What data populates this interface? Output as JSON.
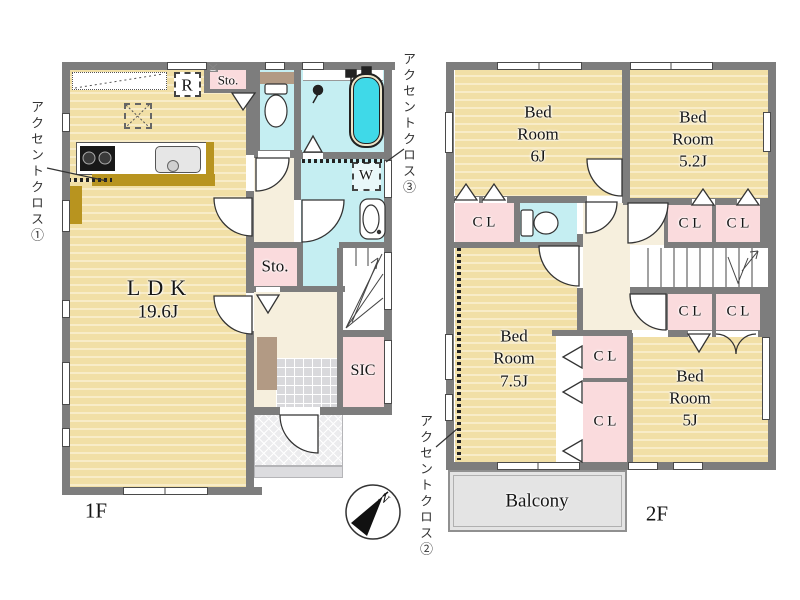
{
  "floor1": {
    "label": "1F",
    "ldk_name": "LDK",
    "ldk_size": "19.6J",
    "storage_top": "Sto.",
    "storage_mid": "Sto.",
    "sic": "SIC",
    "fridge": "R",
    "washer": "W"
  },
  "floor2": {
    "label": "2F",
    "balcony": "Balcony",
    "closet_label": "C L",
    "bedrooms": [
      {
        "line1": "Bed",
        "line2": "Room",
        "size": "6J"
      },
      {
        "line1": "Bed",
        "line2": "Room",
        "size": "5.2J"
      },
      {
        "line1": "Bed",
        "line2": "Room",
        "size": "7.5J"
      },
      {
        "line1": "Bed",
        "line2": "Room",
        "size": "5J"
      }
    ]
  },
  "annotations": {
    "accent1": "アクセントクロス①",
    "accent2": "アクセントクロス②",
    "accent3": "アクセントクロス③",
    "compass_north": "N"
  },
  "colors": {
    "floor_tan": "#f1dfa6",
    "wet_area_cyan": "#c5eef2",
    "closet_pink": "#fadbdd",
    "hall_cream": "#f6efdd",
    "wall_gray": "#7d7d7d",
    "tub_water": "#3fd9e8",
    "counter_mustard": "#b8941f",
    "shelf_brown": "#b29a84",
    "balcony_gray": "#e4e4e4"
  }
}
